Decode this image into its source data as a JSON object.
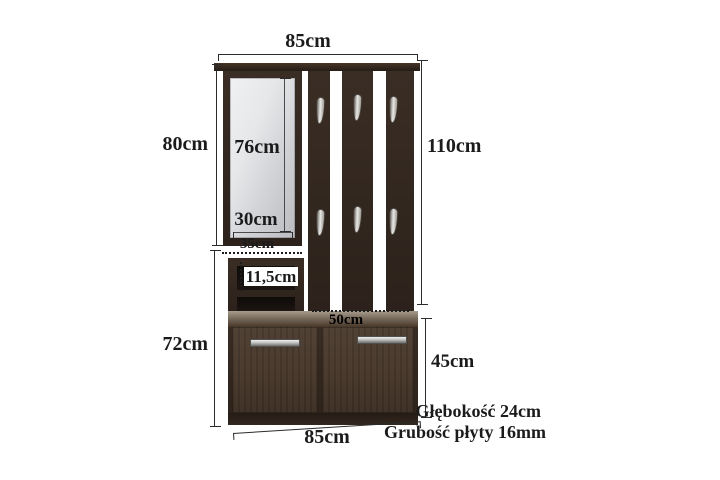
{
  "diagram": {
    "type": "furniture-dimension-diagram",
    "subject": "hallway wardrobe set with mirror, coat hooks and shoe cabinet"
  },
  "labels": {
    "top_width": "85cm",
    "mirror_section_height": "80cm",
    "mirror_height": "76cm",
    "mirror_width": "30cm",
    "panel_height": "110cm",
    "shelf_width": "35cm",
    "shelf_opening_height": "11,5cm",
    "lower_section_height": "72cm",
    "cabinet_inner_width": "50cm",
    "cabinet_front_height": "45cm",
    "bottom_width": "85cm",
    "depth_note": "Głębokość 24cm",
    "board_thickness_note": "Grubość płyty 16mm"
  },
  "icons": {
    "coat_hook": "metal-teardrop-hook",
    "door_handle": "metal-bar-handle"
  },
  "colors": {
    "background": "#ffffff",
    "wood_dark": "#32271f",
    "wood_door": "#453629",
    "cabinet_top_face": "#95897c",
    "mirror_glass": "#e0e2e5",
    "metal": "#c9c9c7",
    "dimension_line": "#2b2b2b",
    "text": "#1b1b1b"
  }
}
